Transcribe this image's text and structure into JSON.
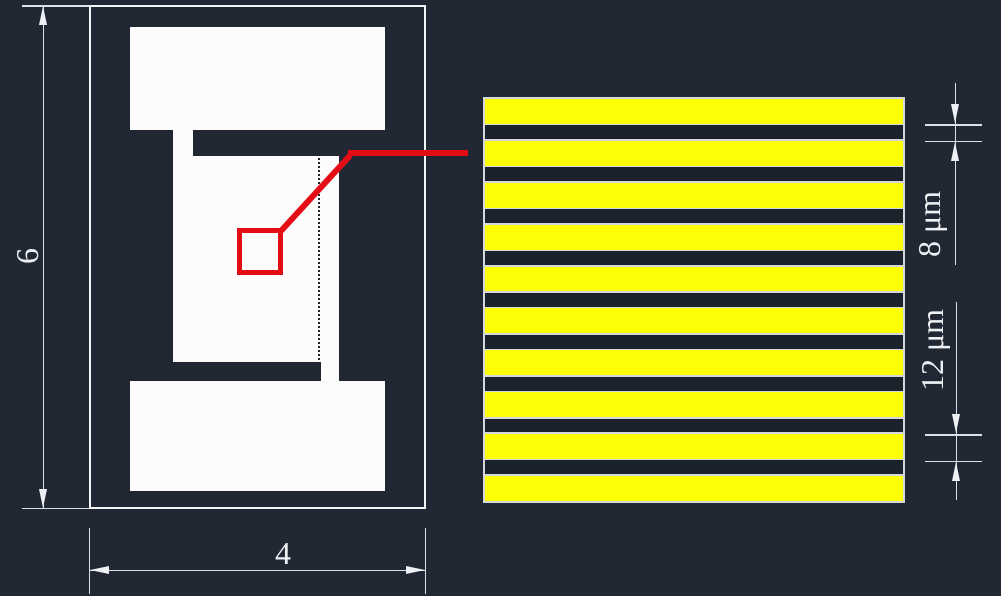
{
  "canvas": {
    "bg_color": "#212733",
    "shape_fill": "#fcfcfc",
    "line_color": "#dde1e6"
  },
  "left_view": {
    "height_dim": {
      "label": "6"
    },
    "width_dim": {
      "label": "4"
    }
  },
  "callout": {
    "color": "#e50d15"
  },
  "detail_view": {
    "yellow_stripes": 10,
    "dark_gaps": 9,
    "yellow_color": "#fdfd05",
    "dark_color": "#1c222c",
    "separator_color": "#d4d8dc",
    "dark_stripe_dim": {
      "label": "8 μm"
    },
    "yellow_stripe_dim": {
      "label": "12 μm"
    }
  }
}
